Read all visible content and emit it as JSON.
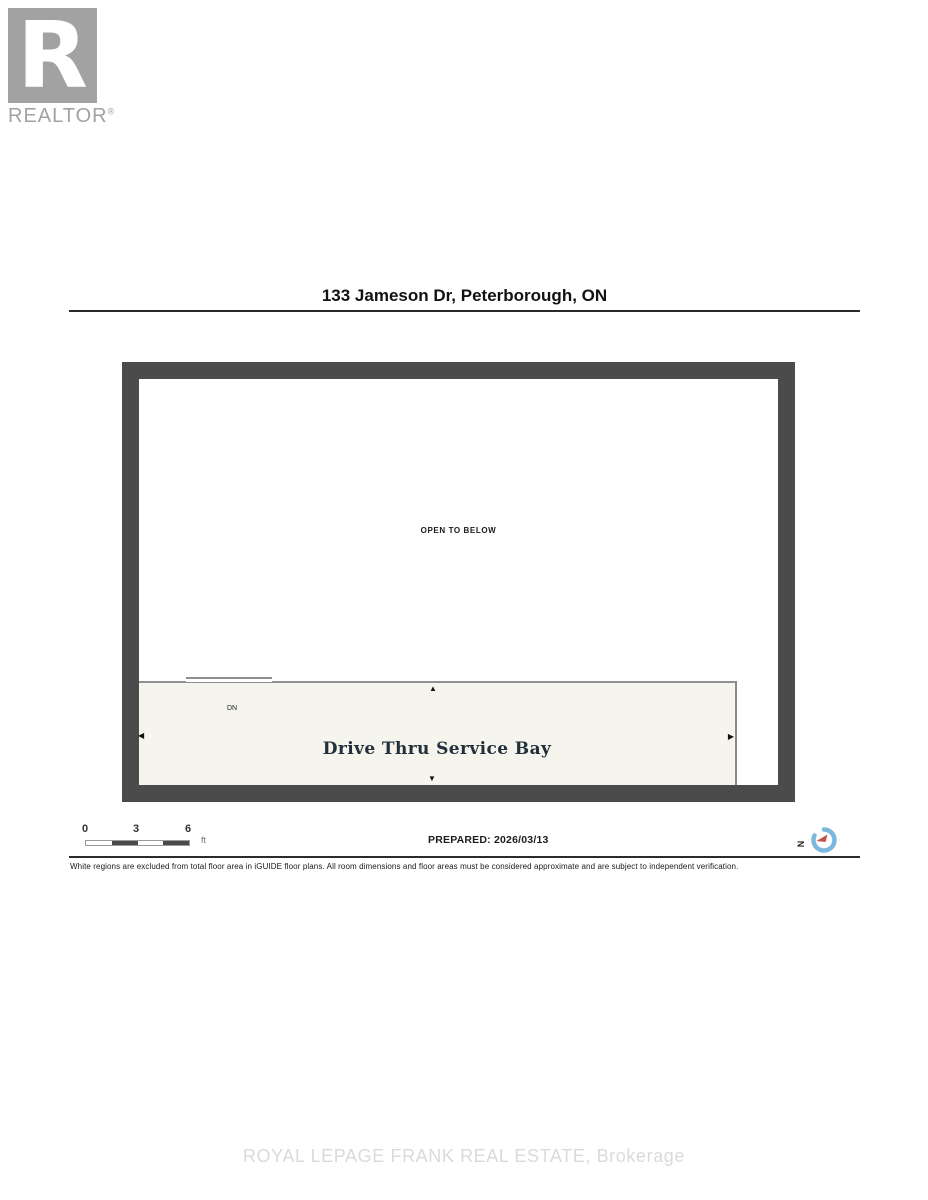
{
  "logo": {
    "letter": "R",
    "label": "REALTOR",
    "registered": "®"
  },
  "header": {
    "title": "133 Jameson Dr, Peterborough, ON"
  },
  "floor_plan": {
    "open_label": "OPEN TO BELOW",
    "bay_label": "Drive Thru Service Bay",
    "dn_label": "DN",
    "arrows": {
      "up": "▲",
      "down": "▼",
      "left": "◀",
      "right": "▶"
    },
    "colors": {
      "wall": "#4b4b4b",
      "bay_fill": "#f5f4ed",
      "line": "#8f8f8f"
    }
  },
  "footer": {
    "scale": {
      "ticks": [
        "0",
        "3",
        "6"
      ],
      "unit": "ft"
    },
    "prepared_label": "PREPARED: 2026/03/13",
    "compass_north": "N",
    "compass_colors": {
      "ring": "#7cb8dd",
      "needle": "#c3524a"
    }
  },
  "disclaimer": "White regions are excluded from total floor area in iGUIDE floor plans. All room dimensions and floor areas must be considered approximate and are subject to independent verification.",
  "watermark": "ROYAL LEPAGE FRANK REAL ESTATE, Brokerage"
}
